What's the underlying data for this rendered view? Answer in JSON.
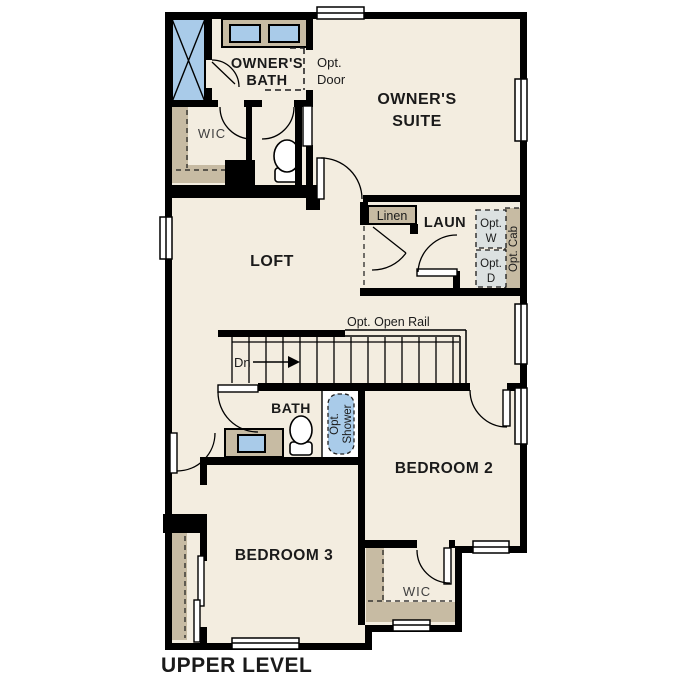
{
  "title": "UPPER LEVEL",
  "colors": {
    "wall": "#000000",
    "floor": "#f3ede0",
    "cabinet_tan": "#c7bba3",
    "fixture_blue": "#a9cbe9",
    "appliance_gray": "#dce1e1",
    "background": "#ffffff"
  },
  "rooms": {
    "owners_bath": {
      "line1": "OWNER'S",
      "line2": "BATH"
    },
    "owners_suite": {
      "line1": "OWNER'S",
      "line2": "SUITE"
    },
    "wic_top": "WIC",
    "loft": "LOFT",
    "linen": "Linen",
    "laun": "LAUN",
    "bath": "BATH",
    "bedroom2": "BEDROOM 2",
    "bedroom3": "BEDROOM 3",
    "wic_bottom": "WIC"
  },
  "annotations": {
    "opt_door": {
      "line1": "Opt.",
      "line2": "Door"
    },
    "opt_w": {
      "line1": "Opt.",
      "line2": "W"
    },
    "opt_d": {
      "line1": "Opt.",
      "line2": "D"
    },
    "opt_cab": "Opt. Cab",
    "opt_shower": {
      "line1": "Opt.",
      "line2": "Shower"
    },
    "opt_open_rail": "Opt. Open Rail",
    "down": "Dn"
  }
}
